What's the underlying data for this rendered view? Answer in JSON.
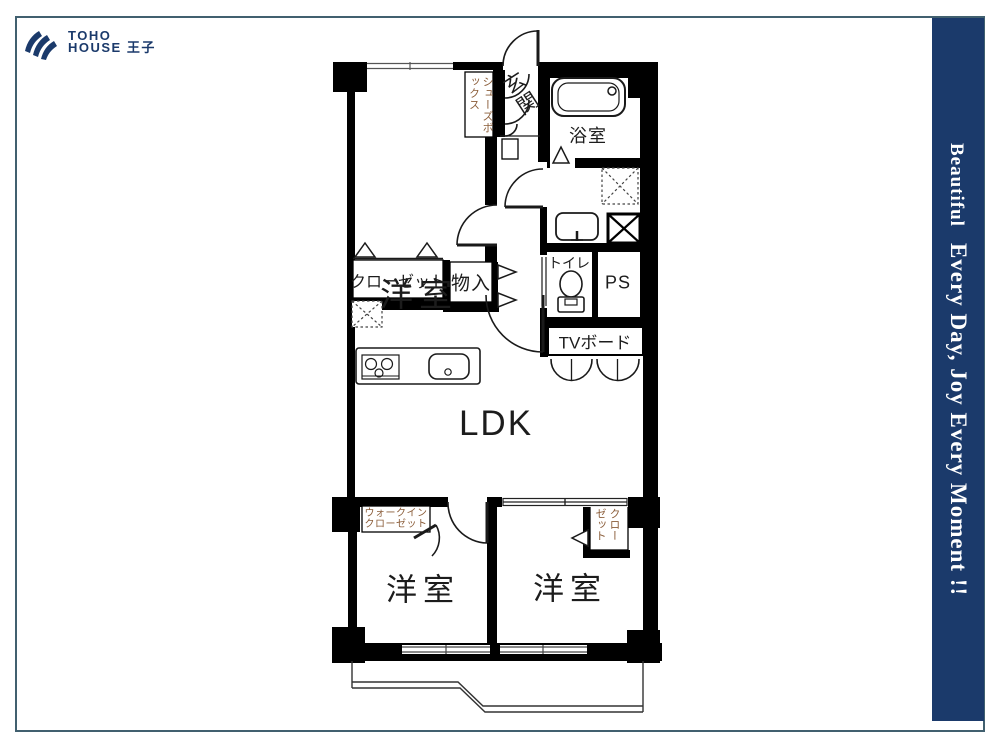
{
  "logo": {
    "line1": "TOHO",
    "line2": "HOUSE 王子"
  },
  "sidebar": {
    "text_small": "Beautiful",
    "text_large": "Every Day, Joy Every Moment !!",
    "background_color": "#1b3a6b",
    "text_color": "#ffffff"
  },
  "colors": {
    "navy": "#1b3a6b",
    "brown_label": "#8a5c38",
    "wall": "#000000",
    "page_border": "#41606f"
  },
  "floorplan": {
    "labels": {
      "bedroom_top": "洋室",
      "closet_top": "クローゼット",
      "storage": "物入",
      "shoe_box": "シューズボックス",
      "entrance": "玄関",
      "bathroom": "浴室",
      "toilet": "トイレ",
      "pipe_space": "PS",
      "tv_board": "TVボード",
      "ldk": "LDK",
      "walk_in_closet_line1": "ウォークイン",
      "walk_in_closet_line2": "クローゼット",
      "bedroom_bottom_left": "洋室",
      "bedroom_bottom_right": "洋室",
      "closet_bottom_right": "クローゼット"
    }
  }
}
